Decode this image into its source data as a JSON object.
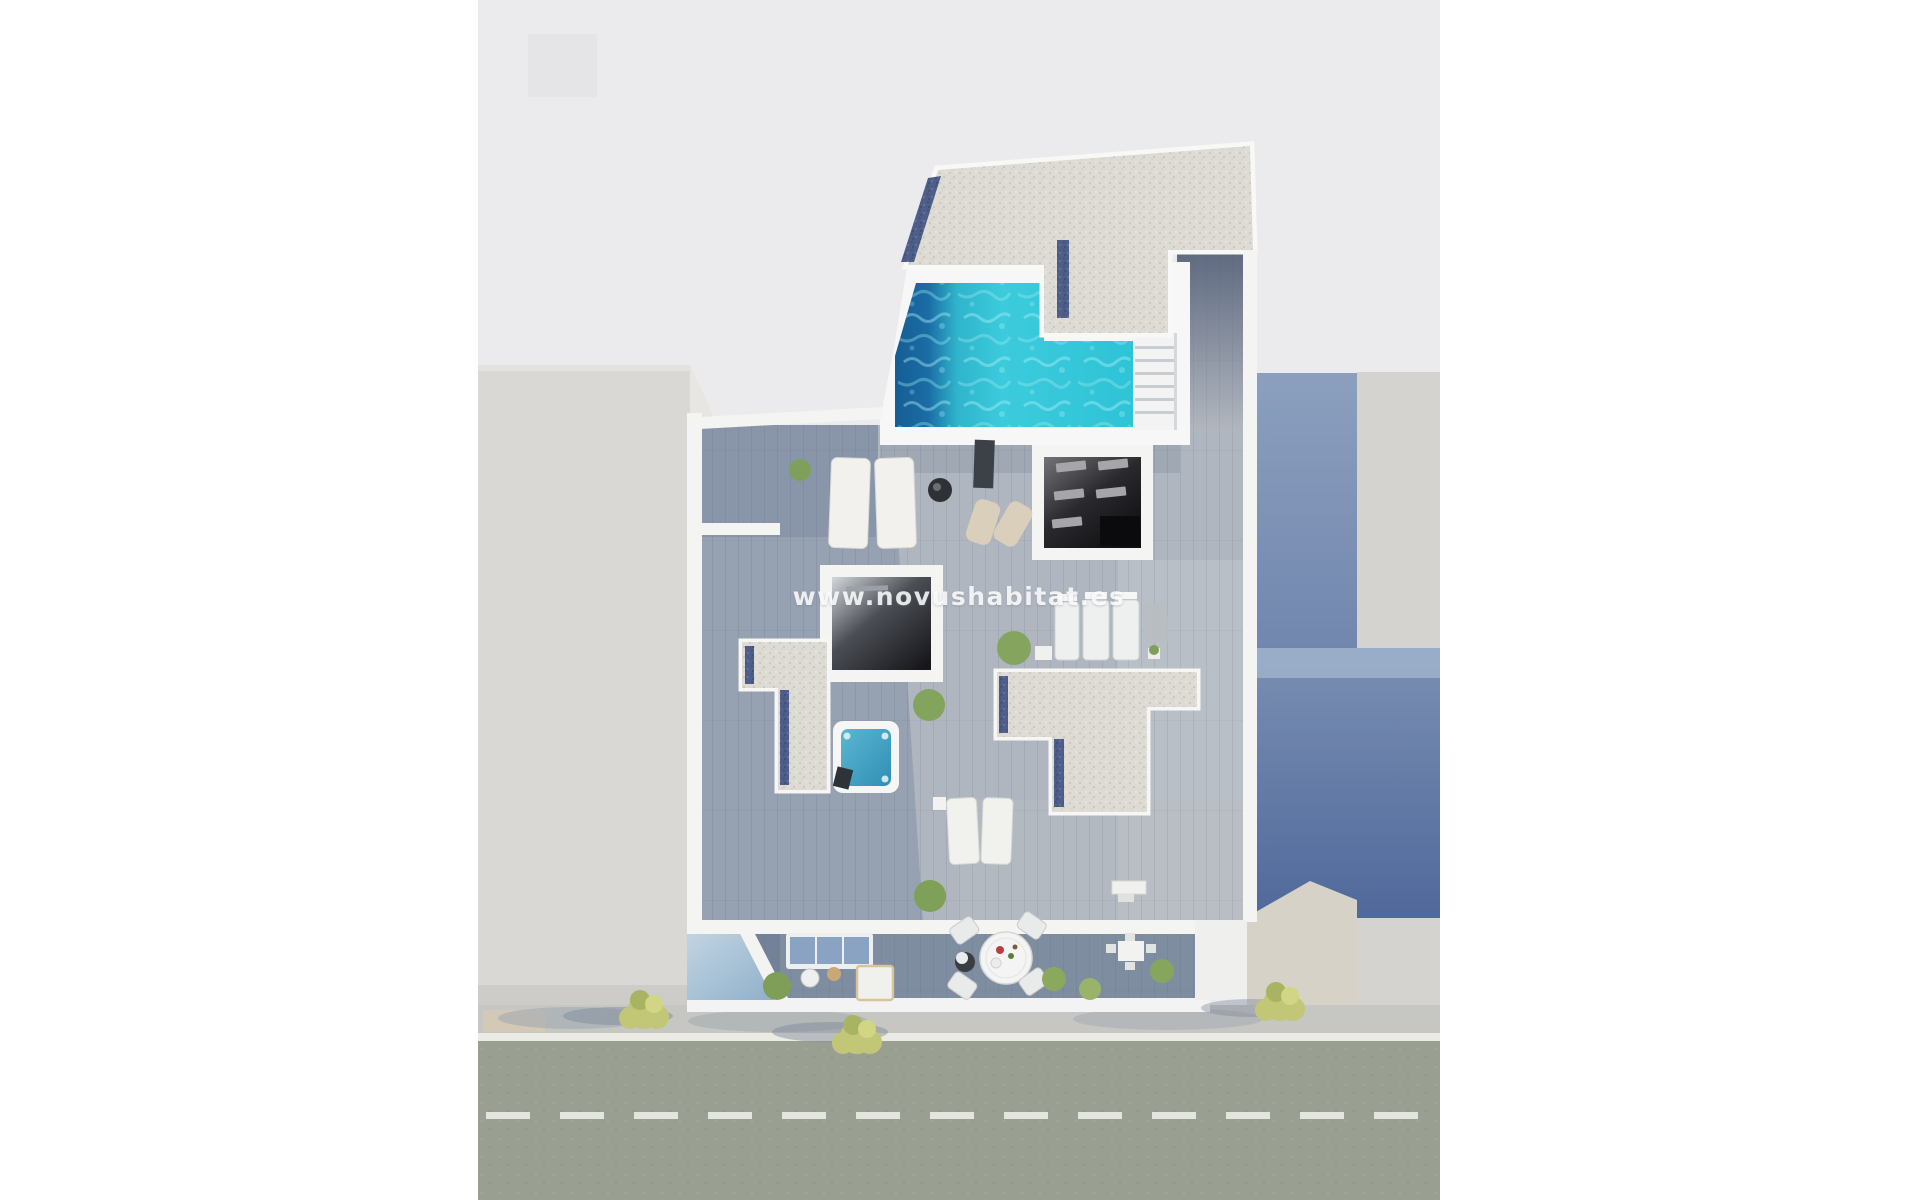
{
  "watermark": {
    "text": "www.novushabitat.es"
  },
  "scene": {
    "type": "aerial-3d-render",
    "description": "Top-down 3D render of a rooftop penthouse with L-shaped pool, gravel roofs, wood deck terraces, jacuzzi, street-facing balconies, sidewalk trees and a road with dashed lane marking"
  },
  "colors": {
    "page_margin": "#ffffff",
    "background_gray": "#ebebed",
    "background_square": "#e5e5e8",
    "left_building": "#d9d8d4",
    "left_building_lit": "#e7e6e2",
    "right_building_light": "#d4d3cf",
    "right_wall_top": "#8c9fbe",
    "right_wall_bottom": "#50699b",
    "corner_lit": "#d6d2c7",
    "white_walls": "#f4f4f2",
    "deck_wood": "#b0b6bf",
    "balcony_floor": "#7f8da1",
    "gravel_roof": "#dedbd4",
    "pebble_border": "#4f5e88",
    "pool_turquoise": "#36cadc",
    "pool_deep_blue": "#155d94",
    "jacuzzi_water": "#3f9fc4",
    "dark_room": "#17171b",
    "sidewalk": "#c6c7c2",
    "curb": "#eceae4",
    "road": "#9aa091",
    "lane_marking": "#e4e5de",
    "tree_foliage": "#c2c778",
    "tree_foliage_dark": "#a9b463",
    "glass_reflection": "#9fbcd2",
    "sofa_cushion": "#8ba3c2",
    "rattan_chair": "#d9cfba"
  }
}
